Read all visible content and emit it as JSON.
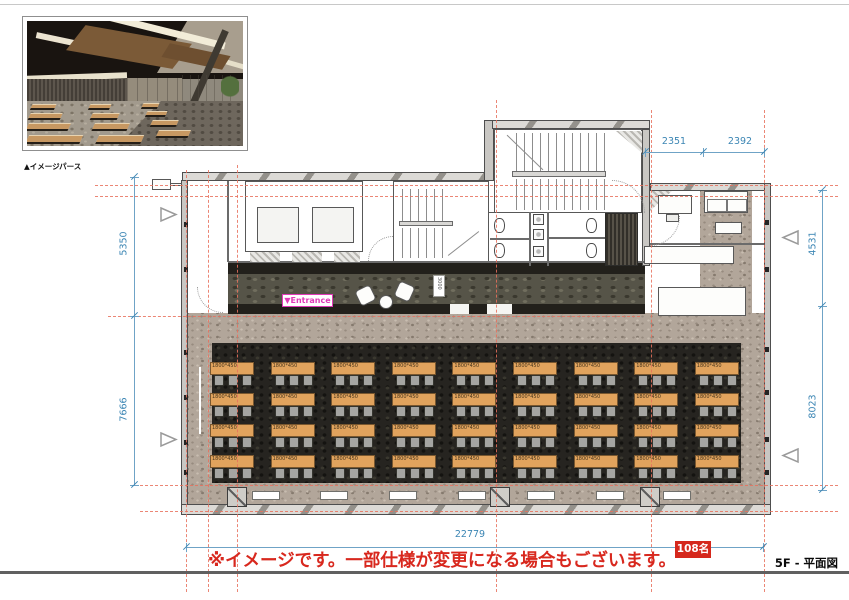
{
  "page": {
    "top_caption": "▲イメージパース",
    "sheet_title": "5F - 平面図",
    "disclaimer": "※イメージです。一部仕様が変更になる場合もございます。",
    "capacity_badge": "108名"
  },
  "dimensions": {
    "top": [
      "2351",
      "2392"
    ],
    "left": [
      "5350",
      "7666"
    ],
    "right": [
      "4531",
      "8023"
    ],
    "bottom": [
      "22779"
    ]
  },
  "plan": {
    "entrance_label": "▼Entrance",
    "lounge_tag": "3000",
    "desk_grid": {
      "rows": 4,
      "cols": 9,
      "chairs_per_desk": 3,
      "desk_label": "1800*450"
    }
  },
  "colors": {
    "dimension_blue": "#3c86b4",
    "grid_red": "#e8715d",
    "alert_red": "#d5281c",
    "entrance_magenta": "#e03ab8",
    "desk_tan": "#e1a35d"
  }
}
